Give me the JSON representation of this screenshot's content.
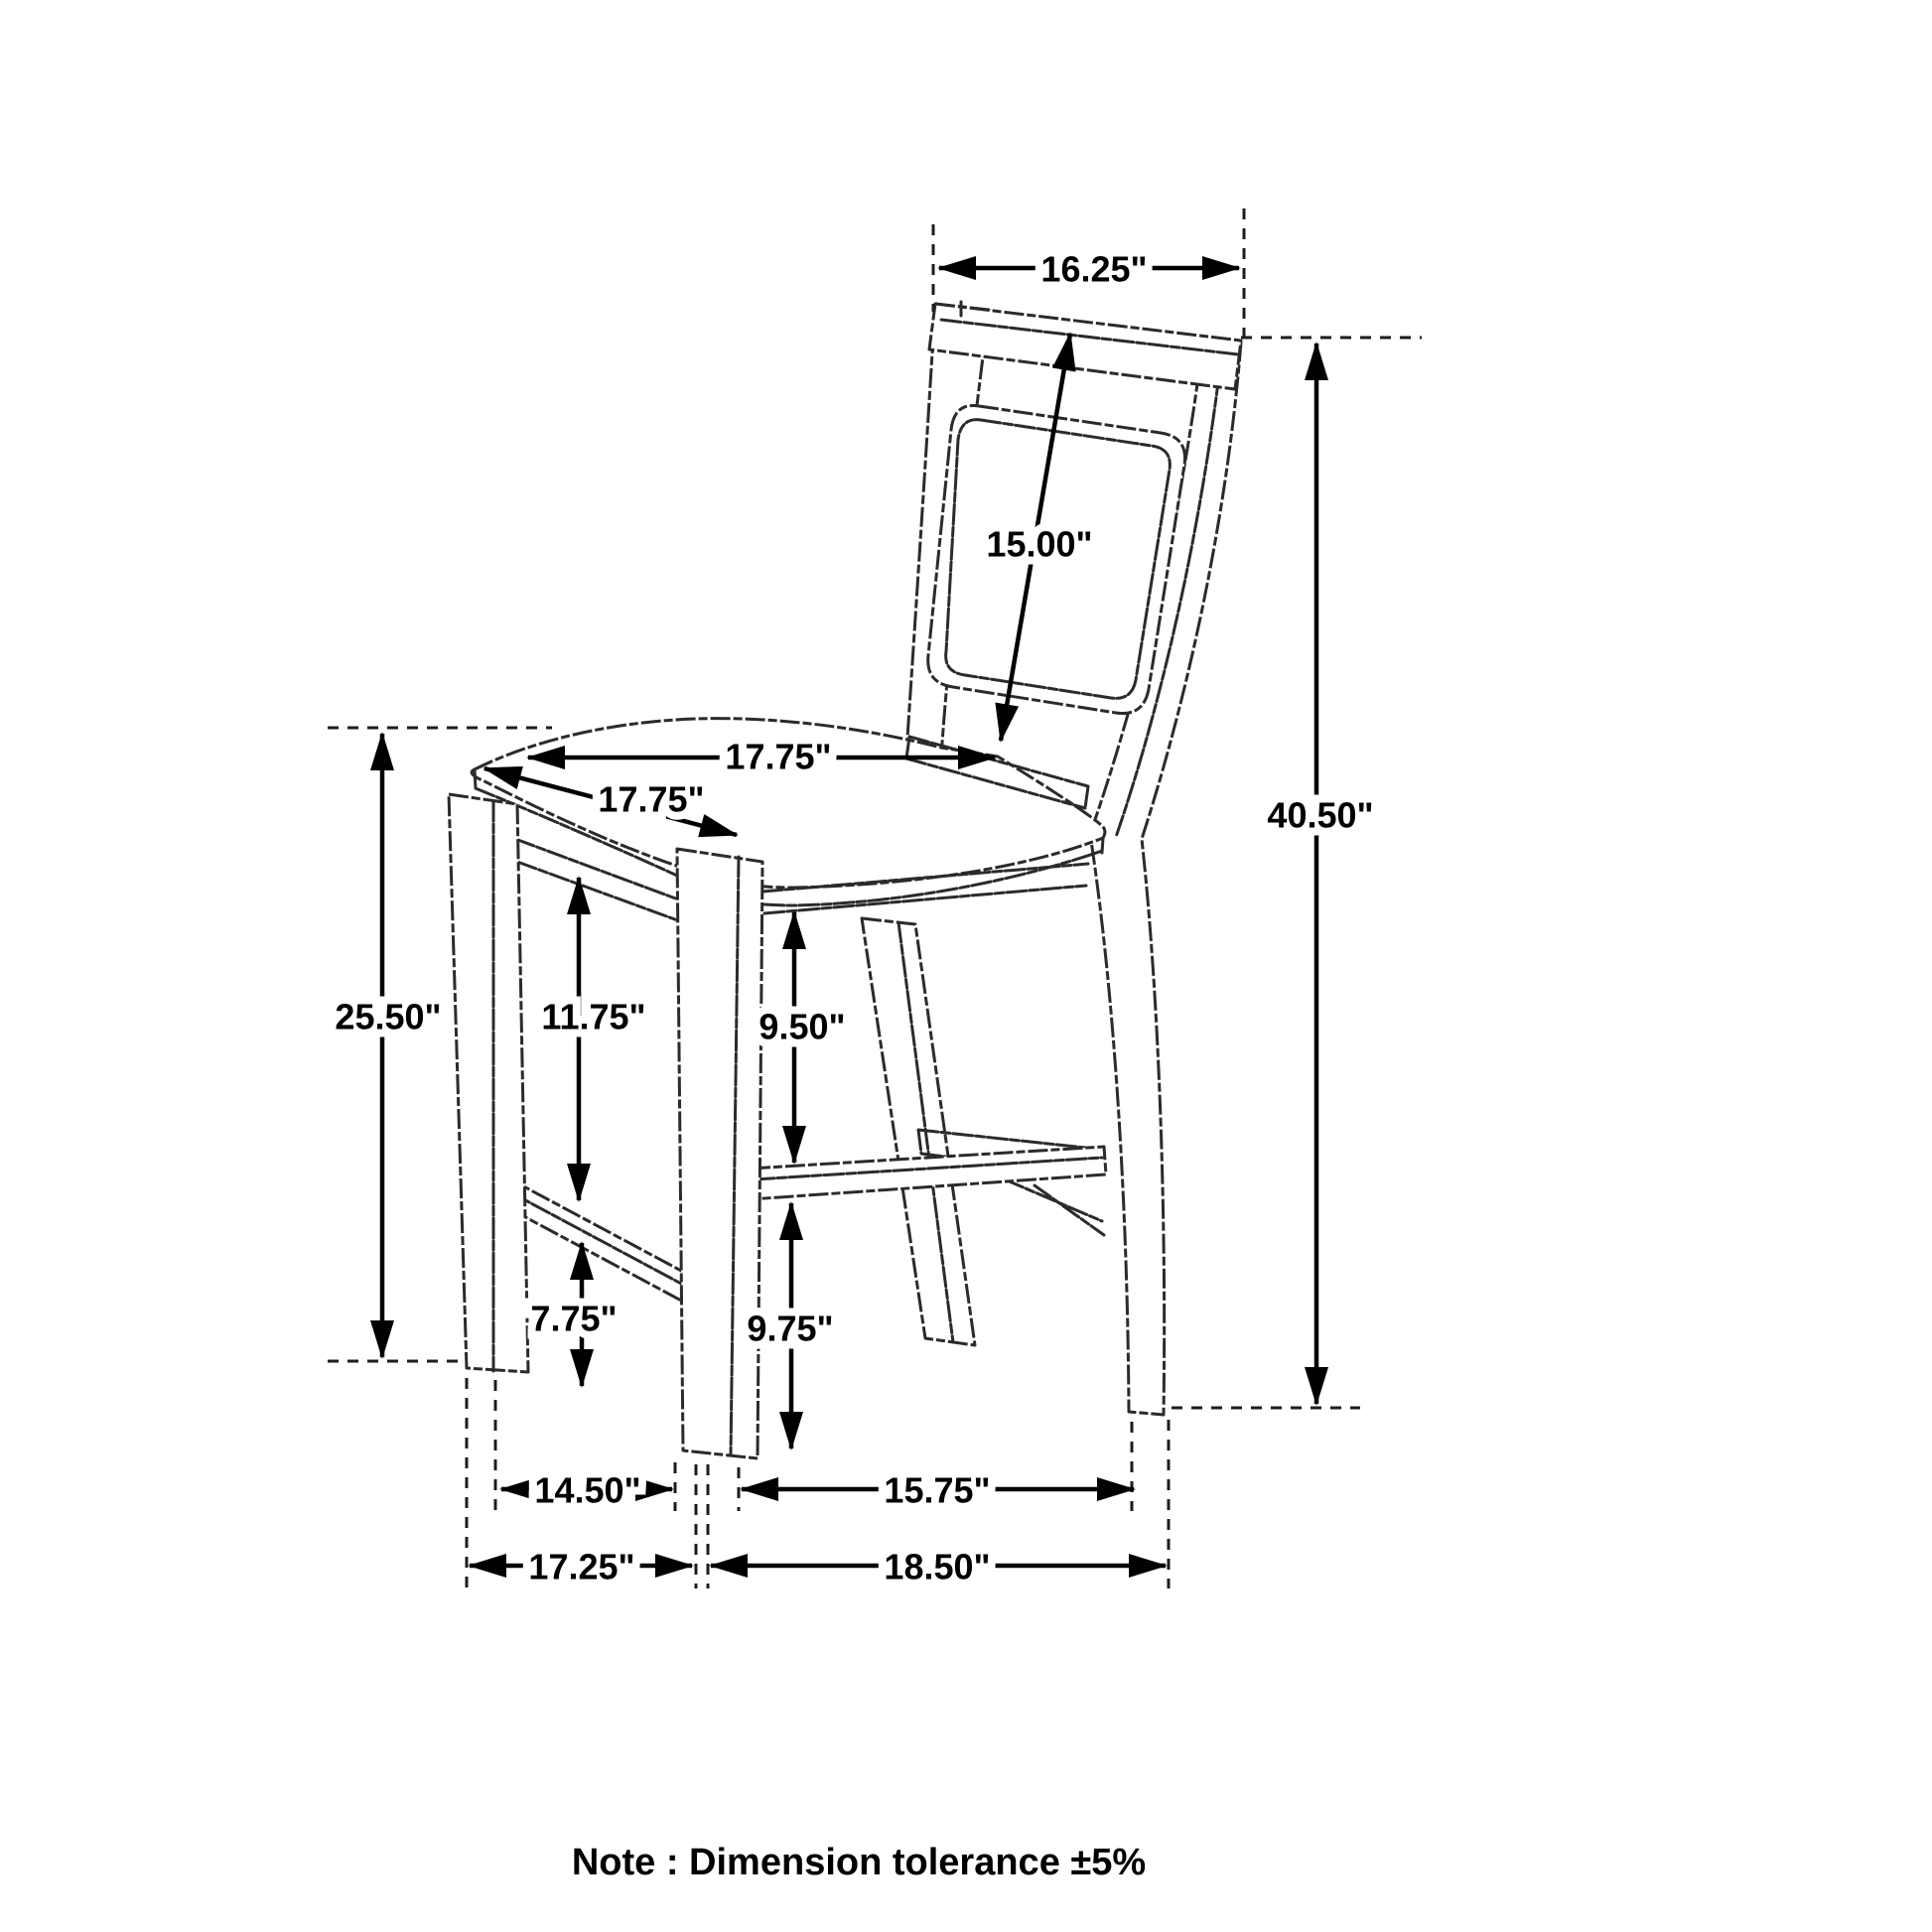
{
  "title": "Counter height chair dimension diagram",
  "note": "Note : Dimension tolerance ±5%",
  "colors": {
    "line": "#2b2b2b",
    "dimension": "#000000",
    "background": "#ffffff"
  },
  "dims": {
    "back_width": "16.25\"",
    "back_panel_height": "15.00\"",
    "overall_height": "40.50\"",
    "seat_width": "17.75\"",
    "seat_depth": "17.75\"",
    "seat_height": "25.50\"",
    "seat_to_front_stretcher": "11.75\"",
    "seat_to_side_stretcher": "9.50\"",
    "front_stretcher_to_floor": "7.75\"",
    "side_stretcher_to_floor": "9.75\"",
    "front_leg_spacing": "14.50\"",
    "side_leg_spacing": "15.75\"",
    "base_front_width": "17.25\"",
    "base_side_depth": "18.50\""
  }
}
